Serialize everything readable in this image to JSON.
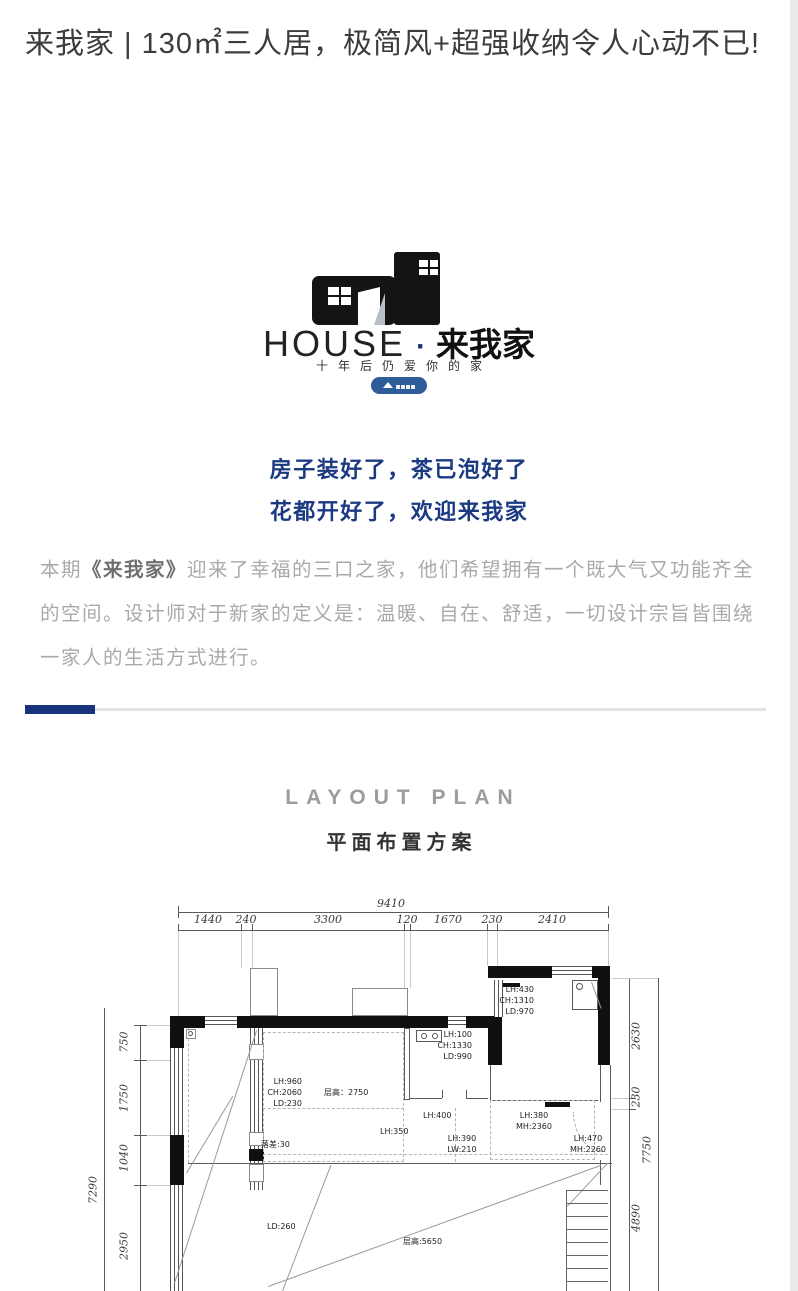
{
  "header": {
    "title": "来我家 | 130㎡三人居，极简风+超强收纳令人心动不已!"
  },
  "brand": {
    "name_en": "HOUSE",
    "separator": "·",
    "name_cn": "来我家",
    "tagline": "十年后仍爱你的家",
    "badge_icon": "mountain-triangle-logo"
  },
  "slogan": {
    "line1": "房子装好了，茶已泡好了",
    "line2": "花都开好了，欢迎来我家"
  },
  "intro": {
    "pre": "本期",
    "highlight": "《来我家》",
    "rest": "迎来了幸福的三口之家，他们希望拥有一个既大气又功能齐全的空间。设计师对于新家的定义是：温暖、自在、舒适，一切设计宗旨皆围绕一家人的生活方式进行。"
  },
  "section": {
    "title_en": "LAYOUT PLAN",
    "title_cn": "平面布置方案"
  },
  "floor_plan": {
    "dims_top": {
      "total": "9410",
      "segments": [
        "1440",
        "240",
        "3300",
        "120",
        "1670",
        "230",
        "2410"
      ]
    },
    "dims_left": {
      "total": "7290",
      "segments": [
        "750",
        "1750",
        "1040",
        "2950"
      ]
    },
    "dims_right": {
      "total": "7750",
      "segments": [
        "2630",
        "230",
        "4890"
      ]
    },
    "labels": [
      {
        "name": "room-left",
        "text": "LH:960\nCH:2060\nLD:230"
      },
      {
        "name": "ceiling-2750",
        "text": "层高：2750"
      },
      {
        "name": "drop-30",
        "text": "落差:30"
      },
      {
        "name": "room-top",
        "text": "LH:100\nCH:1330\nLD:990"
      },
      {
        "name": "kitchen",
        "text": "LH:430\nCH:1310\nLD:970"
      },
      {
        "name": "lh-400",
        "text": "LH:400"
      },
      {
        "name": "lh-350",
        "text": "LH:350"
      },
      {
        "name": "lh-390",
        "text": "LH:390\nLW:210"
      },
      {
        "name": "lh-380",
        "text": "LH:380\nMH:2360"
      },
      {
        "name": "lh-470",
        "text": "LH:470\nMH:2260"
      },
      {
        "name": "ld-260",
        "text": "LD:260"
      },
      {
        "name": "ceiling-5650",
        "text": "层高:5650"
      }
    ]
  },
  "colors": {
    "accent_navy": "#17337c",
    "badge_blue": "#2d5c99",
    "title_text": "#3c3c3c",
    "paragraph_gray": "#a9a9a9",
    "section_gray": "#9c9c9c",
    "plan_line": "#5a5a5a"
  }
}
